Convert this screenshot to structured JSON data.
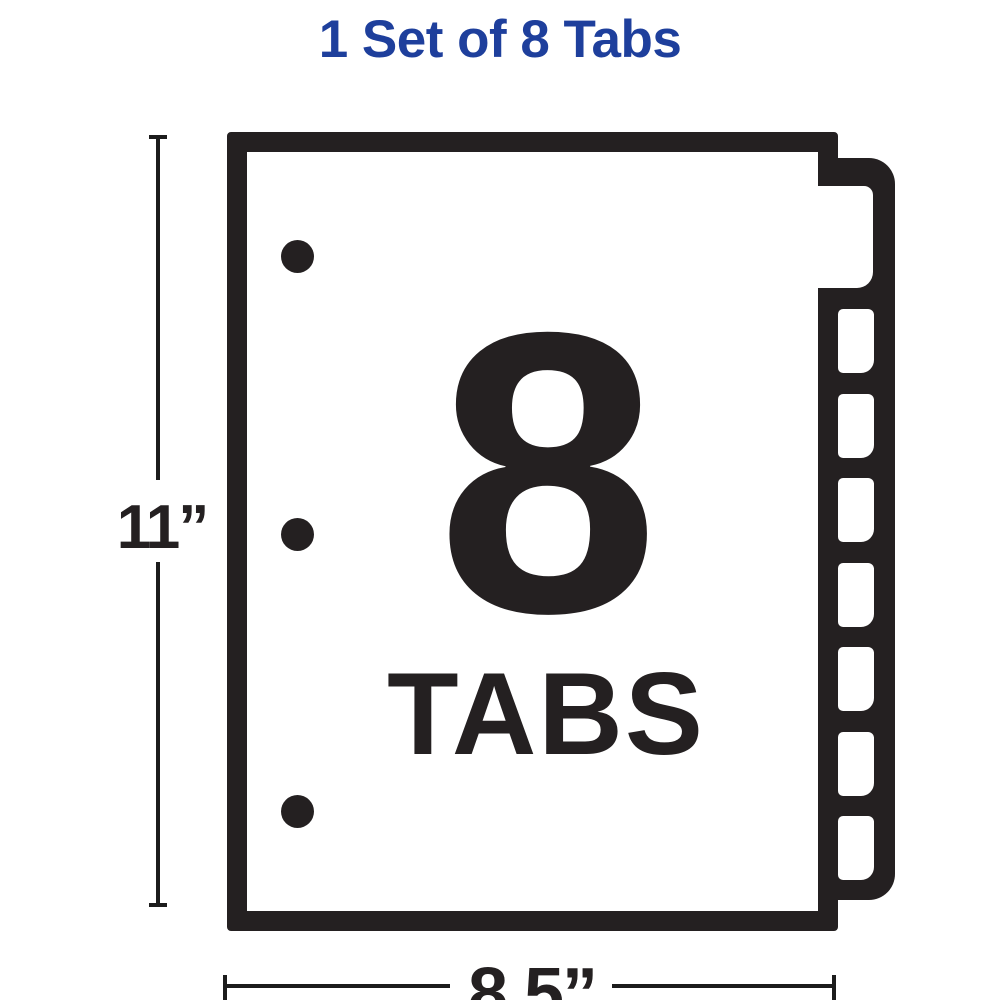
{
  "title": {
    "text": "1 Set of 8 Tabs"
  },
  "colors": {
    "title_blue": "#1e3f9c",
    "ink_black": "#242021",
    "dimension_line": "#1c1c1c",
    "background": "#ffffff"
  },
  "illustration": {
    "tab_count_number": "8",
    "tab_count_word": "TABS",
    "tab_count": 8,
    "punch_hole_count": 3
  },
  "dimensions": {
    "height_label": "11”",
    "width_label": "8.5”"
  }
}
